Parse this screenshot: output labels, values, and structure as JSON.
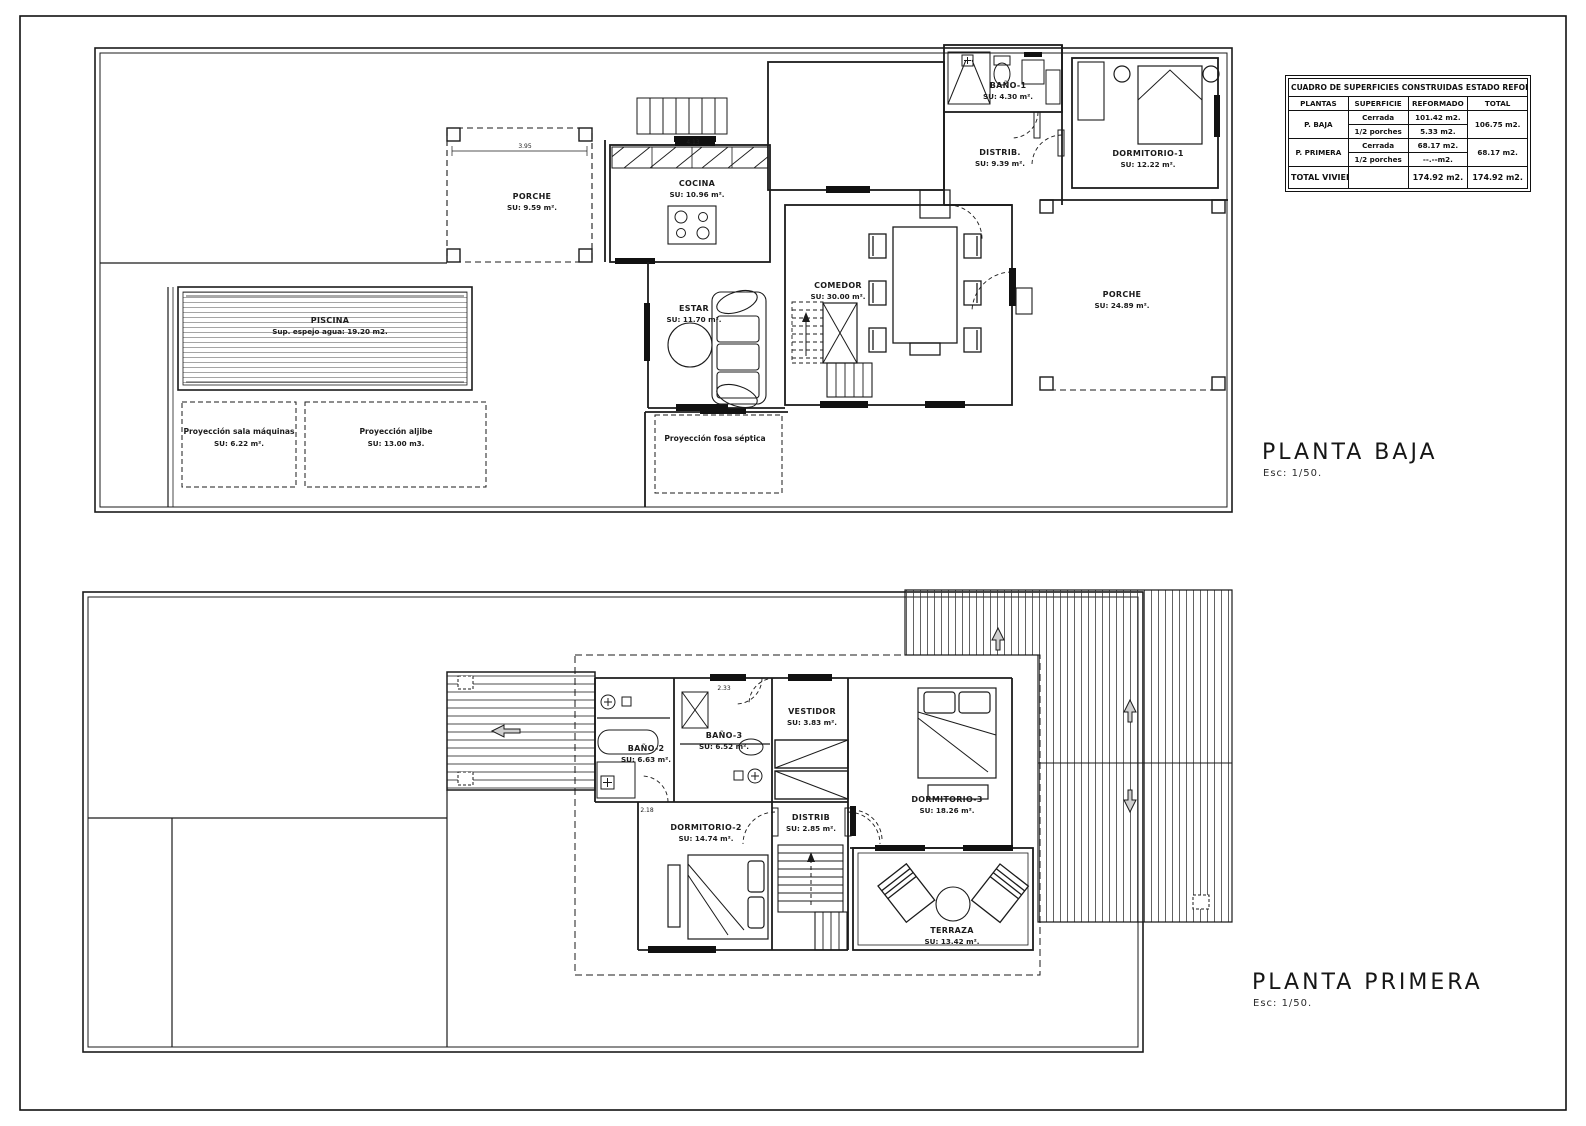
{
  "sheet": {
    "title_baja": "PLANTA BAJA",
    "scale_baja": "Esc: 1/50.",
    "title_primera": "PLANTA PRIMERA",
    "scale_primera": "Esc: 1/50."
  },
  "table": {
    "title": "CUADRO DE SUPERFICIES CONSTRUIDAS ESTADO REFORMADO",
    "headers": [
      "PLANTAS",
      "SUPERFICIE",
      "REFORMADO",
      "TOTAL"
    ],
    "rows": [
      {
        "planta": "P. BAJA",
        "sub": [
          [
            "Cerrada",
            "101.42 m2."
          ],
          [
            "1/2 porches",
            "5.33 m2."
          ]
        ],
        "total": "106.75 m2."
      },
      {
        "planta": "P. PRIMERA",
        "sub": [
          [
            "Cerrada",
            "68.17 m2."
          ],
          [
            "1/2 porches",
            "--.--m2."
          ]
        ],
        "total": "68.17 m2."
      }
    ],
    "total_row": {
      "label": "TOTAL VIVIENDA:",
      "superficie": "",
      "reformado": "174.92 m2.",
      "total": "174.92 m2."
    }
  },
  "baja": {
    "porche_nw": {
      "name": "PORCHE",
      "area": "SU: 9.59 m²."
    },
    "cocina": {
      "name": "COCINA",
      "area": "SU: 10.96 m²."
    },
    "estar": {
      "name": "ESTAR",
      "area": "SU: 11.70 m²."
    },
    "comedor": {
      "name": "COMEDOR",
      "area": "SU: 30.00 m²."
    },
    "banyo1": {
      "name": "BAÑO-1",
      "area": "SU: 4.30 m²."
    },
    "distrib": {
      "name": "DISTRIB.",
      "area": "SU: 9.39 m²."
    },
    "dormitorio1": {
      "name": "DORMITORIO-1",
      "area": "SU: 12.22 m²."
    },
    "porche_e": {
      "name": "PORCHE",
      "area": "SU: 24.89 m²."
    },
    "piscina": {
      "name": "PISCINA",
      "area": "Sup. espejo agua: 19.20 m2."
    },
    "sala_maquinas": {
      "name": "Proyección sala máquinas",
      "area": "SU: 6.22 m²."
    },
    "aljibe": {
      "name": "Proyección aljibe",
      "area": "SU: 13.00 m3."
    },
    "fosa": {
      "name": "Proyección fosa séptica"
    }
  },
  "primera": {
    "banyo2": {
      "name": "BAÑO-2",
      "area": "SU: 6.63 m²."
    },
    "banyo3": {
      "name": "BAÑO-3",
      "area": "SU: 6.52 m²."
    },
    "vestidor": {
      "name": "VESTIDOR",
      "area": "SU: 3.83 m²."
    },
    "distrib": {
      "name": "DISTRIB",
      "area": "SU: 2.85 m²."
    },
    "dormitorio2": {
      "name": "DORMITORIO-2",
      "area": "SU: 14.74 m²."
    },
    "dormitorio3": {
      "name": "DORMITORIO-3",
      "area": "SU: 18.26 m²."
    },
    "terraza": {
      "name": "TERRAZA",
      "area": "SU: 13.42 m²."
    }
  },
  "dims": {
    "porche_w": "3.95",
    "cocina_w": "4.13",
    "banyo3_w": "2.33",
    "banyo2_w": "2.18"
  },
  "colors": {
    "line": "#1b1b1b",
    "hatch": "#3a3a3a",
    "water": "#8f8f8f",
    "paper": "#ffffff"
  }
}
